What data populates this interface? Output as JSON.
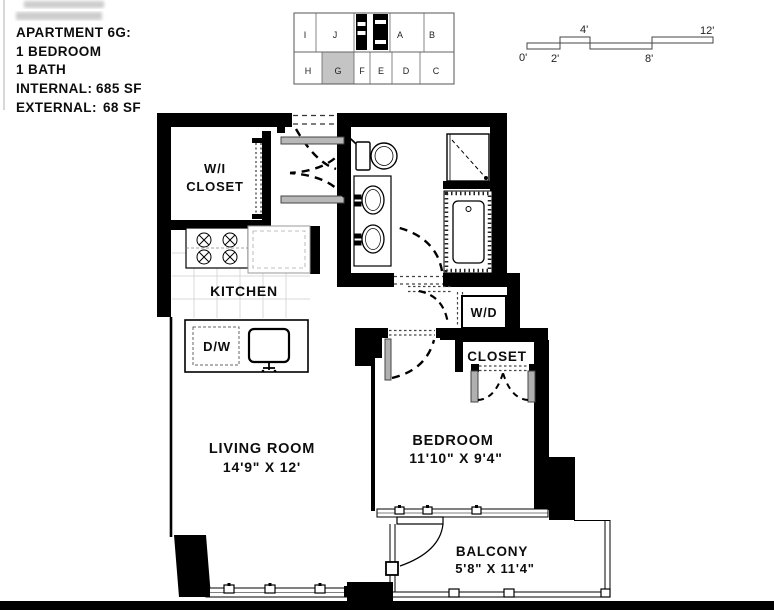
{
  "header": {
    "title": "APARTMENT 6G:",
    "bedrooms": "1 BEDROOM",
    "baths": "1 BATH",
    "internal_label": "INTERNAL:",
    "internal_value": "685 SF",
    "external_label": "EXTERNAL:",
    "external_value": "68 SF"
  },
  "key_plan": {
    "top_units": [
      "I",
      "J",
      "A",
      "B"
    ],
    "bottom_units": [
      "H",
      "G",
      "F",
      "E",
      "D",
      "C"
    ],
    "highlighted_unit": "G",
    "highlight_color": "#c4c4c4"
  },
  "scale_bar": {
    "tick_0": "0'",
    "tick_2": "2'",
    "tick_4": "4'",
    "tick_8": "8'",
    "tick_12": "12'"
  },
  "rooms": {
    "walk_in_closet": {
      "label_line1": "W/I",
      "label_line2": "CLOSET"
    },
    "kitchen": {
      "label": "KITCHEN"
    },
    "dishwasher": {
      "label": "D/W"
    },
    "living_room": {
      "label": "LIVING ROOM",
      "dimensions": "14'9\" X 12'"
    },
    "bedroom": {
      "label": "BEDROOM",
      "dimensions": "11'10\" X 9'4\""
    },
    "bedroom_closet": {
      "label": "CLOSET"
    },
    "washer_dryer": {
      "label": "W/D"
    },
    "balcony": {
      "label": "BALCONY",
      "dimensions": "5'8\" X 11'4\""
    }
  },
  "colors": {
    "wall": "#000000",
    "unit_highlight": "#c4c4c4"
  }
}
